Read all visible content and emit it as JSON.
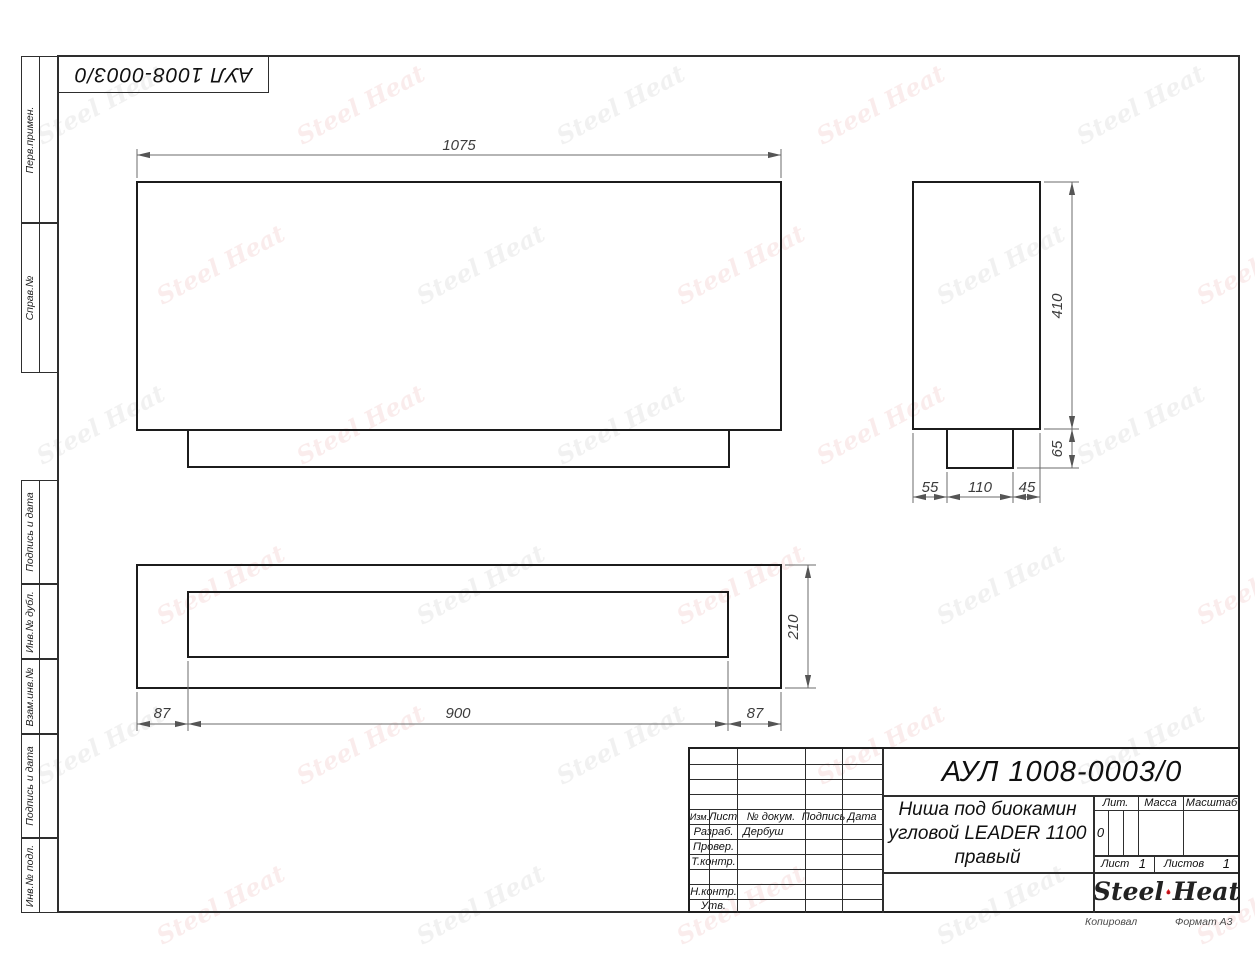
{
  "sheet": {
    "top_designation": "АУЛ 1008-0003/0",
    "footer": {
      "copied": "Копировал",
      "format": "Формат А3"
    }
  },
  "sidebar": {
    "items": [
      {
        "label": "Перв.примен."
      },
      {
        "label": "Справ.№"
      },
      {
        "label": "Подпись и дата"
      },
      {
        "label": "Инв.№ дубл."
      },
      {
        "label": "Взам.инв.№"
      },
      {
        "label": "Подпись и дата"
      },
      {
        "label": "Инв.№ подл."
      }
    ]
  },
  "dimensions": {
    "front_width": "1075",
    "side_height": "410",
    "foot_height": "65",
    "side_seg1": "55",
    "side_seg2": "110",
    "side_seg3": "45",
    "plan_left": "87",
    "plan_opening": "900",
    "plan_right": "87",
    "plan_depth": "210"
  },
  "title_block": {
    "designation": "АУЛ 1008-0003/0",
    "product_name_lines": [
      "Ниша под биокамин",
      "угловой LEADER 1100",
      "правый"
    ],
    "header": {
      "izm": "Изм.",
      "list": "Лист",
      "doc": "№ докум.",
      "podpis": "Подпись",
      "data": "Дата"
    },
    "roles": {
      "razrab": "Разраб.",
      "prover": "Провер.",
      "tkontr": "Т.контр.",
      "nkontr": "Н.контр.",
      "utv": "Утв."
    },
    "values": {
      "razrab_name": "Дербуш"
    },
    "lit": {
      "label": "Лит.",
      "value": "0"
    },
    "massa_label": "Масса",
    "masshtab_label": "Масштаб",
    "sheet_row": {
      "list_label": "Лист",
      "list_value": "1",
      "listov_label": "Листов",
      "listov_value": "1"
    },
    "logo": {
      "steel": "Steel",
      "heat": "Heat"
    }
  },
  "watermark": {
    "text_left": "Steel",
    "text_right": "Heat"
  },
  "colors": {
    "accent_red": "#e31e24",
    "line_dark": "#1c1c1c",
    "line_dim": "#666666"
  }
}
